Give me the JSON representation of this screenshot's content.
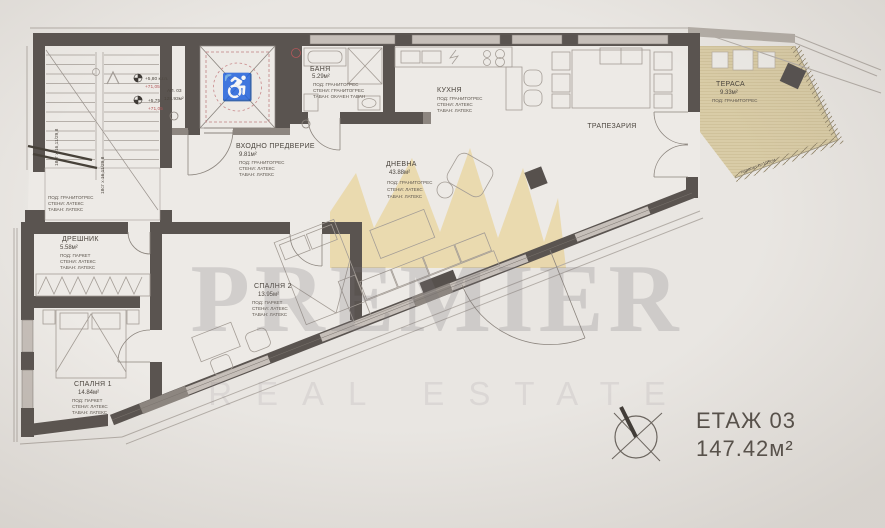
{
  "floor_summary": {
    "floor": "ЕТАЖ 03",
    "total_area": "147.42м²"
  },
  "apartment": {
    "label": "АП. 03",
    "area": "128.93м²"
  },
  "levels": {
    "mark1": "+5,80 к.г.п.",
    "mark1_alt": "+71,05",
    "mark2": "+5,75",
    "mark2_alt": "+71,05"
  },
  "stairs": {
    "flight1": "18ст x 16,11/29,8",
    "flight2": "18ст x 16,11/29,8",
    "floor": "ПОД: ГРАНИТОГРЕС",
    "walls": "СТЕНИ: ЛАТЕКС",
    "ceiling": "ТАВАН: ЛАТЕКС"
  },
  "rooms": {
    "bath": {
      "name": "БАНЯ",
      "area": "5.29м²",
      "floor": "ПОД: ГРАНИТОГРЕС",
      "walls": "СТЕНИ: ГРАНИТОГРЕС",
      "ceiling": "ТАВАН: ОКАЧЕН ТАВАН"
    },
    "entry": {
      "name": "ВХОДНО ПРЕДВЕРИЕ",
      "area": "9.81м²",
      "floor": "ПОД: ГРАНИТОГРЕС",
      "walls": "СТЕНИ: ЛАТЕКС",
      "ceiling": "ТАВАН: ЛАТЕКС"
    },
    "kitchen": {
      "name": "КУХНЯ",
      "floor": "ПОД: ГРАНИТОГРЕС",
      "walls": "СТЕНИ: ЛАТЕКС",
      "ceiling": "ТАВАН: ЛАТЕКС"
    },
    "dining": {
      "name": "ТРАПЕЗАРИЯ"
    },
    "living": {
      "name": "ДНЕВНА",
      "area": "43.88м²",
      "floor": "ПОД: ГРАНИТОГРЕС",
      "walls": "СТЕНИ: ЛАТЕКС",
      "ceiling": "ТАВАН: ЛАТЕКС"
    },
    "terrace": {
      "name": "ТЕРАСА",
      "area": "9.33м²",
      "floor": "ПОД: ГРАНИТОГРЕС",
      "parapet_note": "парапет h=105см"
    },
    "closet": {
      "name": "ДРЕШНИК",
      "area": "5.58м²",
      "floor": "ПОД: ПАРКЕТ",
      "walls": "СТЕНИ: ЛАТЕКС",
      "ceiling": "ТАВАН: ЛАТЕКС"
    },
    "bedroom1": {
      "name": "СПАЛНЯ 1",
      "area": "14.84м²",
      "floor": "ПОД: ПАРКЕТ",
      "walls": "СТЕНИ: ЛАТЕКС",
      "ceiling": "ТАВАН: ЛАТЕКС"
    },
    "bedroom2": {
      "name": "СПАЛНЯ 2",
      "area": "13.95м²",
      "floor": "ПОД: ПАРКЕТ",
      "walls": "СТЕНИ: ЛАТЕКС",
      "ceiling": "ТАВАН: ЛАТЕКС"
    }
  },
  "watermark": {
    "brand": "PREMIER",
    "tagline": "REAL ESTATE"
  },
  "colors": {
    "wall_dark": "#5a5450",
    "window": "#c6bfb9",
    "paper": "#e9e6e2",
    "terrace_floor": "#d9cca7",
    "accent_red": "#b4575a",
    "watermark_gold": "#e6c464"
  }
}
